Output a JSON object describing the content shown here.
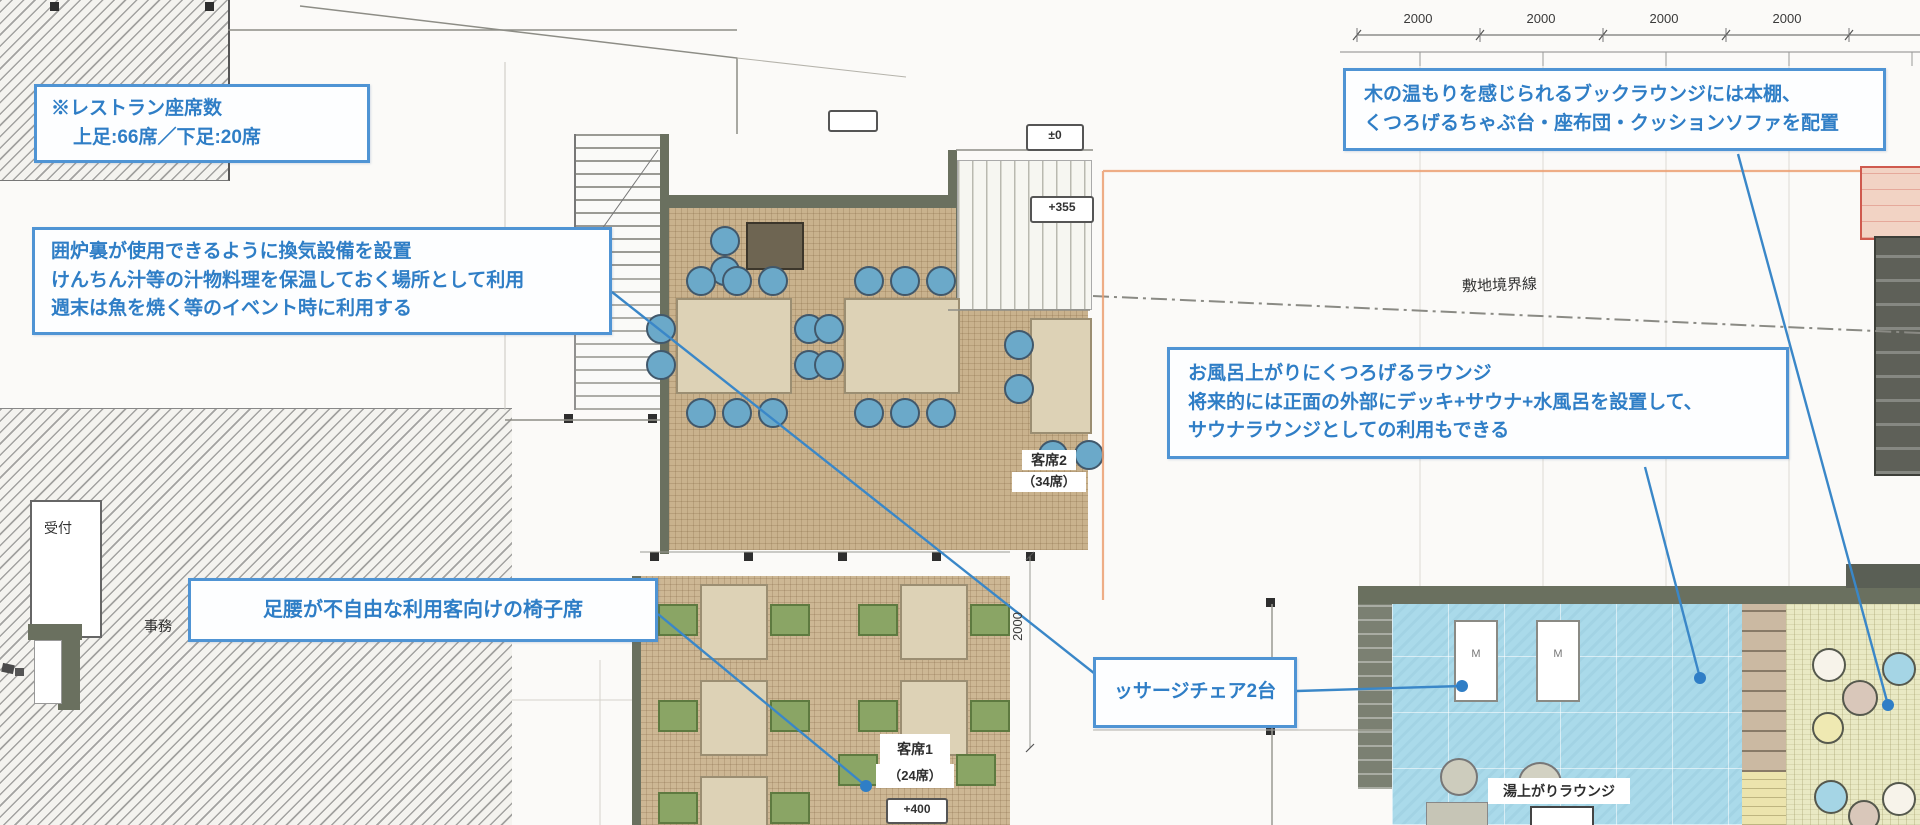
{
  "annotations": {
    "restaurant_seats": {
      "line1": "※レストラン座席数",
      "line2": "上足:66席／下足:20席"
    },
    "irori": {
      "line1": "囲炉裏が使用できるように換気設備を設置",
      "line2": "けんちん汁等の汁物料理を保温しておく場所として利用",
      "line3": "週末は魚を焼く等のイベント時に利用する"
    },
    "chair_seats": {
      "text": "足腰が不自由な利用客向けの椅子席"
    },
    "book_lounge": {
      "line1": "木の温もりを感じられるブックラウンジには本棚、",
      "line2": "くつろげるちゃぶ台・座布団・クッションソファを配置"
    },
    "bath_lounge": {
      "line1": "お風呂上がりにくつろげるラウンジ",
      "line2": "将来的には正面の外部にデッキ+サウナ+水風呂を設置して、",
      "line3": "サウナラウンジとしての利用もできる"
    },
    "massage": {
      "text": "ッサージチェア2台"
    }
  },
  "labels": {
    "reception": "受付",
    "office": "事務",
    "seating2": "客席2",
    "seating2_count": "（34席）",
    "seating1": "客席1",
    "seating1_count": "（24席）",
    "level_400": "+400",
    "level_0": "±0",
    "level_355": "+355",
    "site_boundary": "敷地境界線",
    "bath_lounge": "湯上がりラウンジ",
    "massage_m": "M"
  },
  "dimensions": {
    "d1": "2000",
    "d2": "2000",
    "d3": "2000",
    "d4": "2000",
    "side": "2000"
  },
  "colors": {
    "annotation_border": "#4f94d4",
    "annotation_text": "#2f7ec6",
    "leader_blue": "#3a87c8",
    "tatami_tan": "#c9b28d",
    "bath_blue": "#aadaea",
    "book_floor": "#e9e9c4",
    "wall_grey_green": "#6a705f",
    "chair_blue": "#6ba9c9",
    "chair_green": "#8aa565",
    "setback_orange": "#eb9f72",
    "boundary_box_red": "#cf5a4e"
  }
}
